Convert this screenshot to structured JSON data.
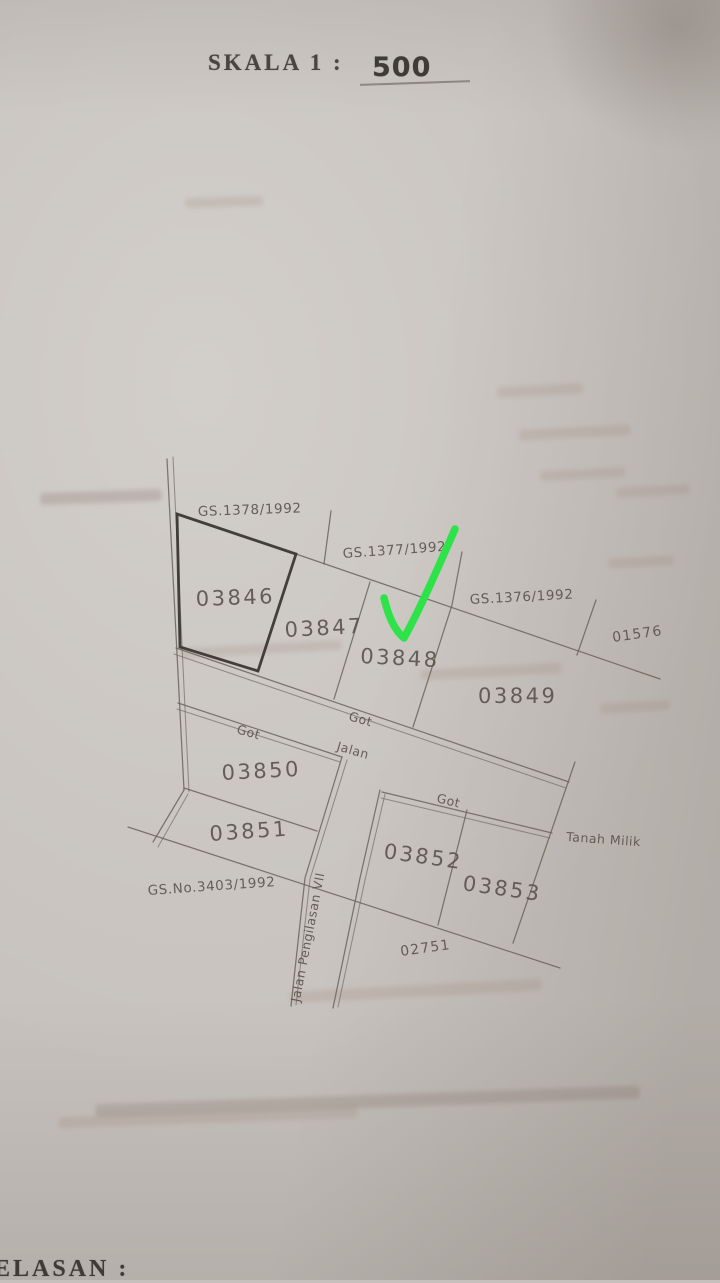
{
  "scale_bar": {
    "label": "SKALA 1 :",
    "value": "500"
  },
  "map": {
    "gs_references": [
      {
        "label": "GS.1378/1992"
      },
      {
        "label": "GS.1377/1992"
      },
      {
        "label": "GS.1376/1992"
      },
      {
        "label": "GS.No.3403/1992"
      }
    ],
    "parcels": [
      {
        "number": "03846",
        "bold_boundary": true
      },
      {
        "number": "03847"
      },
      {
        "number": "03848",
        "checked": true
      },
      {
        "number": "03849"
      },
      {
        "number": "03850"
      },
      {
        "number": "03851"
      },
      {
        "number": "03852"
      },
      {
        "number": "03853"
      },
      {
        "number": "01576"
      },
      {
        "number": "02751"
      }
    ],
    "road_labels": {
      "jalan": "Jalan",
      "got_upper": "Got",
      "got_lower": "Got",
      "got_right": "Got",
      "street_name": "Jalan  Pengilasan  VII",
      "tanah_milik": "Tanah  Milik"
    },
    "check_color": "#2ee34a"
  },
  "footer": {
    "partial_text": "ELASAN :"
  }
}
